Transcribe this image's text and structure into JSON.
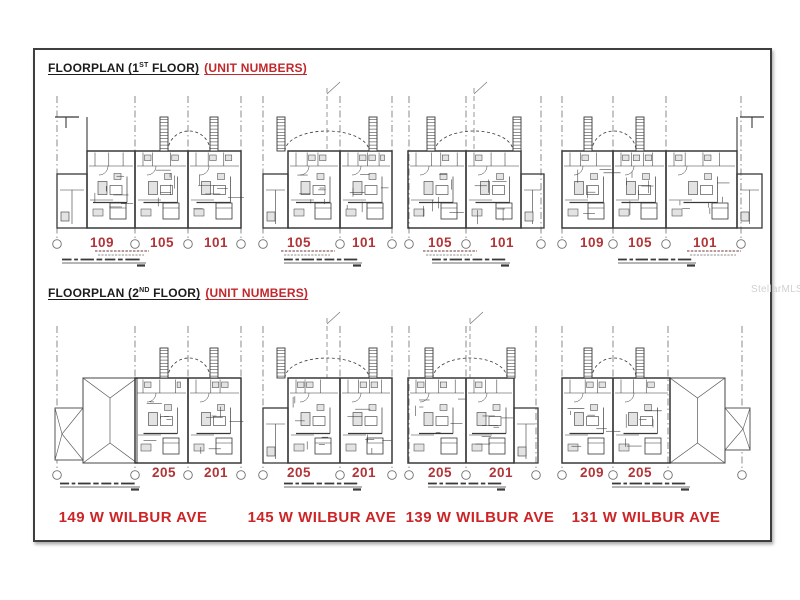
{
  "titles": {
    "floor1": {
      "prefix": "FLOORPLAN (1",
      "sup": "ST",
      "suffix": " FLOOR)",
      "highlight": "(UNIT NUMBERS)"
    },
    "floor2": {
      "prefix": "FLOORPLAN (2",
      "sup": "ND",
      "suffix": " FLOOR)",
      "highlight": "(UNIT NUMBERS)"
    }
  },
  "addresses": [
    {
      "text": "149 W WILBUR AVE"
    },
    {
      "text": "145 W WILBUR AVE"
    },
    {
      "text": "139 W WILBUR AVE"
    },
    {
      "text": "131 W WILBUR AVE"
    }
  ],
  "watermark": "StellarMLS",
  "colors": {
    "title_text": "#1c1c1c",
    "highlight_red": "#c1272b",
    "unit_red": "#b13538",
    "address_red": "#cd2527",
    "plan_line": "#383838",
    "grid_line": "#6e6e6e",
    "fixture_fill": "#e3e3e3",
    "roof_line": "#575757"
  },
  "row_params": {
    "1": {
      "gridTop": 96,
      "towerTop": 117,
      "bodyTop": 151,
      "annexTop": 174,
      "bodyBot": 228,
      "gridBot": 239,
      "circleY": 244,
      "labelY": 247,
      "fineY": 251,
      "capY": 261
    },
    "2": {
      "gridTop": 326,
      "towerTop": 348,
      "bodyTop": 378,
      "annexTop": 408,
      "bodyBot": 463,
      "gridBot": 470,
      "circleY": 475,
      "labelY": 477,
      "fineY": null,
      "capY": 485
    }
  },
  "plans": [
    {
      "floor": 1,
      "seed": 11,
      "main": [
        87,
        241
      ],
      "annex": {
        "side": "left",
        "x0": 57,
        "x1": 87
      },
      "towers": [
        164,
        214
      ],
      "archC": 189,
      "mast": false,
      "tbar": {
        "side": "left",
        "h": [
          55,
          79
        ],
        "stem": 66,
        "edge": 87
      },
      "grids": [
        57,
        135,
        188,
        241
      ],
      "dividers": [
        135,
        188
      ],
      "units": [
        {
          "label": "109",
          "cx": 102
        },
        {
          "label": "105",
          "cx": 162
        },
        {
          "label": "101",
          "cx": 216
        }
      ],
      "fineCx": 122,
      "caption": {
        "x": 62,
        "w": 84
      }
    },
    {
      "floor": 1,
      "seed": 22,
      "main": [
        288,
        392
      ],
      "annex": {
        "side": "left",
        "x0": 263,
        "x1": 288
      },
      "towers": [
        281,
        373
      ],
      "archC": 327,
      "mast": true,
      "grids": [
        263,
        340,
        392
      ],
      "dividers": [
        340
      ],
      "units": [
        {
          "label": "105",
          "cx": 299
        },
        {
          "label": "101",
          "cx": 364
        }
      ],
      "fineCx": 308,
      "caption": {
        "x": 284,
        "w": 78
      }
    },
    {
      "floor": 1,
      "seed": 33,
      "main": [
        408,
        521
      ],
      "annex": {
        "side": "right",
        "x0": 521,
        "x1": 544
      },
      "towers": [
        431,
        517
      ],
      "archC": 474,
      "mast": true,
      "grids": [
        409,
        466,
        541
      ],
      "dividers": [
        466
      ],
      "units": [
        {
          "label": "105",
          "cx": 440
        },
        {
          "label": "101",
          "cx": 502
        }
      ],
      "fineCx": 450,
      "caption": {
        "x": 432,
        "w": 78
      }
    },
    {
      "floor": 1,
      "seed": 44,
      "main": [
        562,
        737
      ],
      "annex": {
        "side": "right",
        "x0": 737,
        "x1": 762
      },
      "towers": [
        588,
        640
      ],
      "archC": 614,
      "mast": false,
      "tbar": {
        "side": "right",
        "h": [
          740,
          764
        ],
        "stem": 752,
        "edge": 737
      },
      "grids": [
        562,
        613,
        666,
        741
      ],
      "dividers": [
        613,
        666
      ],
      "units": [
        {
          "label": "109",
          "cx": 592
        },
        {
          "label": "105",
          "cx": 640
        },
        {
          "label": "101",
          "cx": 705
        }
      ],
      "fineCx": 714,
      "caption": {
        "x": 618,
        "w": 78
      }
    },
    {
      "floor": 2,
      "seed": 55,
      "main": [
        135,
        241
      ],
      "annex": null,
      "roof": {
        "x0": 83,
        "x1": 137,
        "annex": [
          55,
          83
        ],
        "side": "left"
      },
      "towers": [
        164,
        214
      ],
      "archC": 189,
      "mast": false,
      "grids": [
        57,
        135,
        188,
        241
      ],
      "dividers": [
        188
      ],
      "units": [
        {
          "label": "205",
          "cx": 164
        },
        {
          "label": "201",
          "cx": 216
        }
      ],
      "caption": {
        "x": 60,
        "w": 80
      }
    },
    {
      "floor": 2,
      "seed": 66,
      "main": [
        288,
        392
      ],
      "annex": {
        "side": "left",
        "x0": 263,
        "x1": 288
      },
      "towers": [
        281,
        373
      ],
      "archC": 327,
      "mast": true,
      "grids": [
        263,
        340,
        392
      ],
      "dividers": [
        340
      ],
      "units": [
        {
          "label": "205",
          "cx": 299
        },
        {
          "label": "201",
          "cx": 364
        }
      ],
      "caption": {
        "x": 284,
        "w": 78
      }
    },
    {
      "floor": 2,
      "seed": 77,
      "main": [
        408,
        514
      ],
      "annex": {
        "side": "right",
        "x0": 514,
        "x1": 538
      },
      "towers": [
        429,
        511
      ],
      "archC": 470,
      "mast": true,
      "grids": [
        409,
        466,
        536
      ],
      "dividers": [
        466
      ],
      "units": [
        {
          "label": "205",
          "cx": 440
        },
        {
          "label": "201",
          "cx": 501
        }
      ],
      "caption": {
        "x": 428,
        "w": 78
      }
    },
    {
      "floor": 2,
      "seed": 88,
      "main": [
        562,
        670
      ],
      "annex": null,
      "roof": {
        "x0": 670,
        "x1": 725,
        "annex": [
          725,
          750
        ],
        "side": "right"
      },
      "towers": [
        588,
        640
      ],
      "archC": 614,
      "mast": false,
      "grids": [
        562,
        613,
        668,
        742
      ],
      "dividers": [
        613
      ],
      "units": [
        {
          "label": "209",
          "cx": 592
        },
        {
          "label": "205",
          "cx": 640
        }
      ],
      "caption": {
        "x": 612,
        "w": 78
      }
    }
  ]
}
